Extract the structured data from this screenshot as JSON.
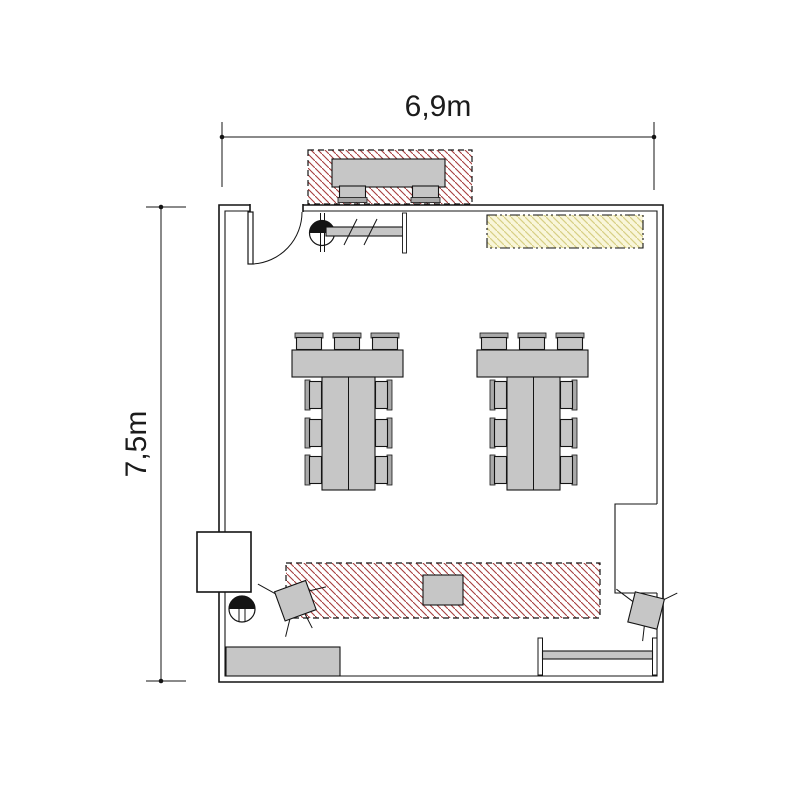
{
  "dimensions": {
    "width_label": "6,9m",
    "height_label": "7,5m"
  },
  "colors": {
    "hatch_red": "#a63d3d",
    "hatch_red_bg": "#ffffff",
    "hatch_yellow": "#d8d084",
    "hatch_yellow_bg": "#f9f6da",
    "furniture": "#c6c6c6",
    "furniture_dark": "#a9a9a9",
    "wall": "#141414",
    "dim_text": "#1b1b1b",
    "background": "#ffffff"
  },
  "icons": {
    "door": "entrance-door-swing",
    "washbasin": "circle-with-half-disc",
    "coat_rail": "rail-with-hanger-slashes",
    "radiator": "i-beam-rail",
    "work_zone": "red-diagonal-hatch",
    "storage_zone": "yellow-diagonal-hatch"
  }
}
